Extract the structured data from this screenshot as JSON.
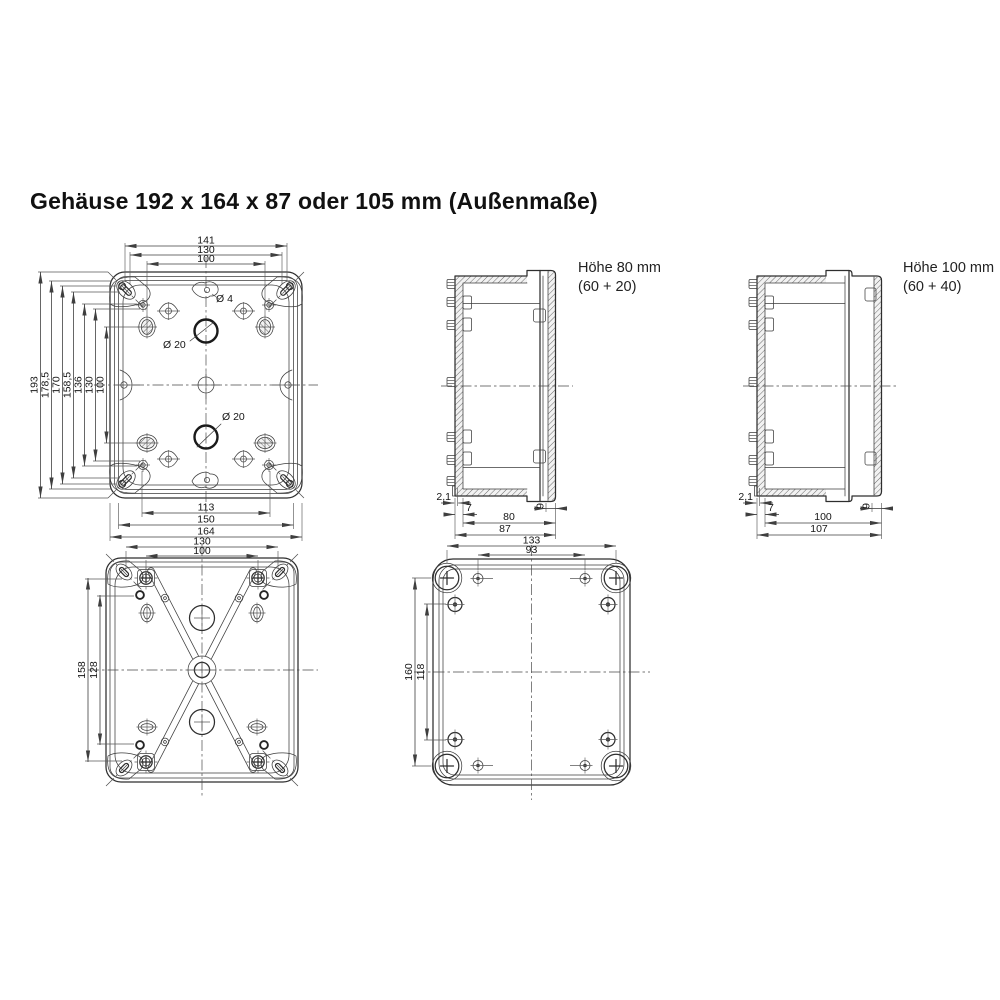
{
  "title": "Gehäuse 192 x 164 x 87 oder 105 mm (Außenmaße)",
  "views": {
    "front": {
      "dims_top": [
        "141",
        "130",
        "100"
      ],
      "dims_left": [
        "193",
        "178,5",
        "170",
        "158,5",
        "136",
        "130",
        "100"
      ],
      "dims_bottom": [
        "113",
        "150",
        "164"
      ],
      "labels": {
        "hole_small": "Ø 4",
        "hole_top": "Ø 20",
        "hole_bottom": "Ø 20"
      }
    },
    "side_80": {
      "caption_line1": "Höhe 80 mm",
      "caption_line2": "(60 + 20)",
      "dim_wall": "2,1",
      "dim_flange": "7",
      "dim_depth": "80",
      "dim_total": "87",
      "dim_lid": "9"
    },
    "side_100": {
      "caption_line1": "Höhe 100 mm",
      "caption_line2": "(60 + 40)",
      "dim_wall": "2,1",
      "dim_flange": "7",
      "dim_depth": "100",
      "dim_total": "107",
      "dim_lid": "9"
    },
    "back": {
      "dims_top": [
        "130",
        "100"
      ],
      "dims_left": [
        "158",
        "128"
      ]
    },
    "cover": {
      "dims_top": [
        "133",
        "93"
      ],
      "dims_left": [
        "160",
        "118"
      ]
    }
  }
}
